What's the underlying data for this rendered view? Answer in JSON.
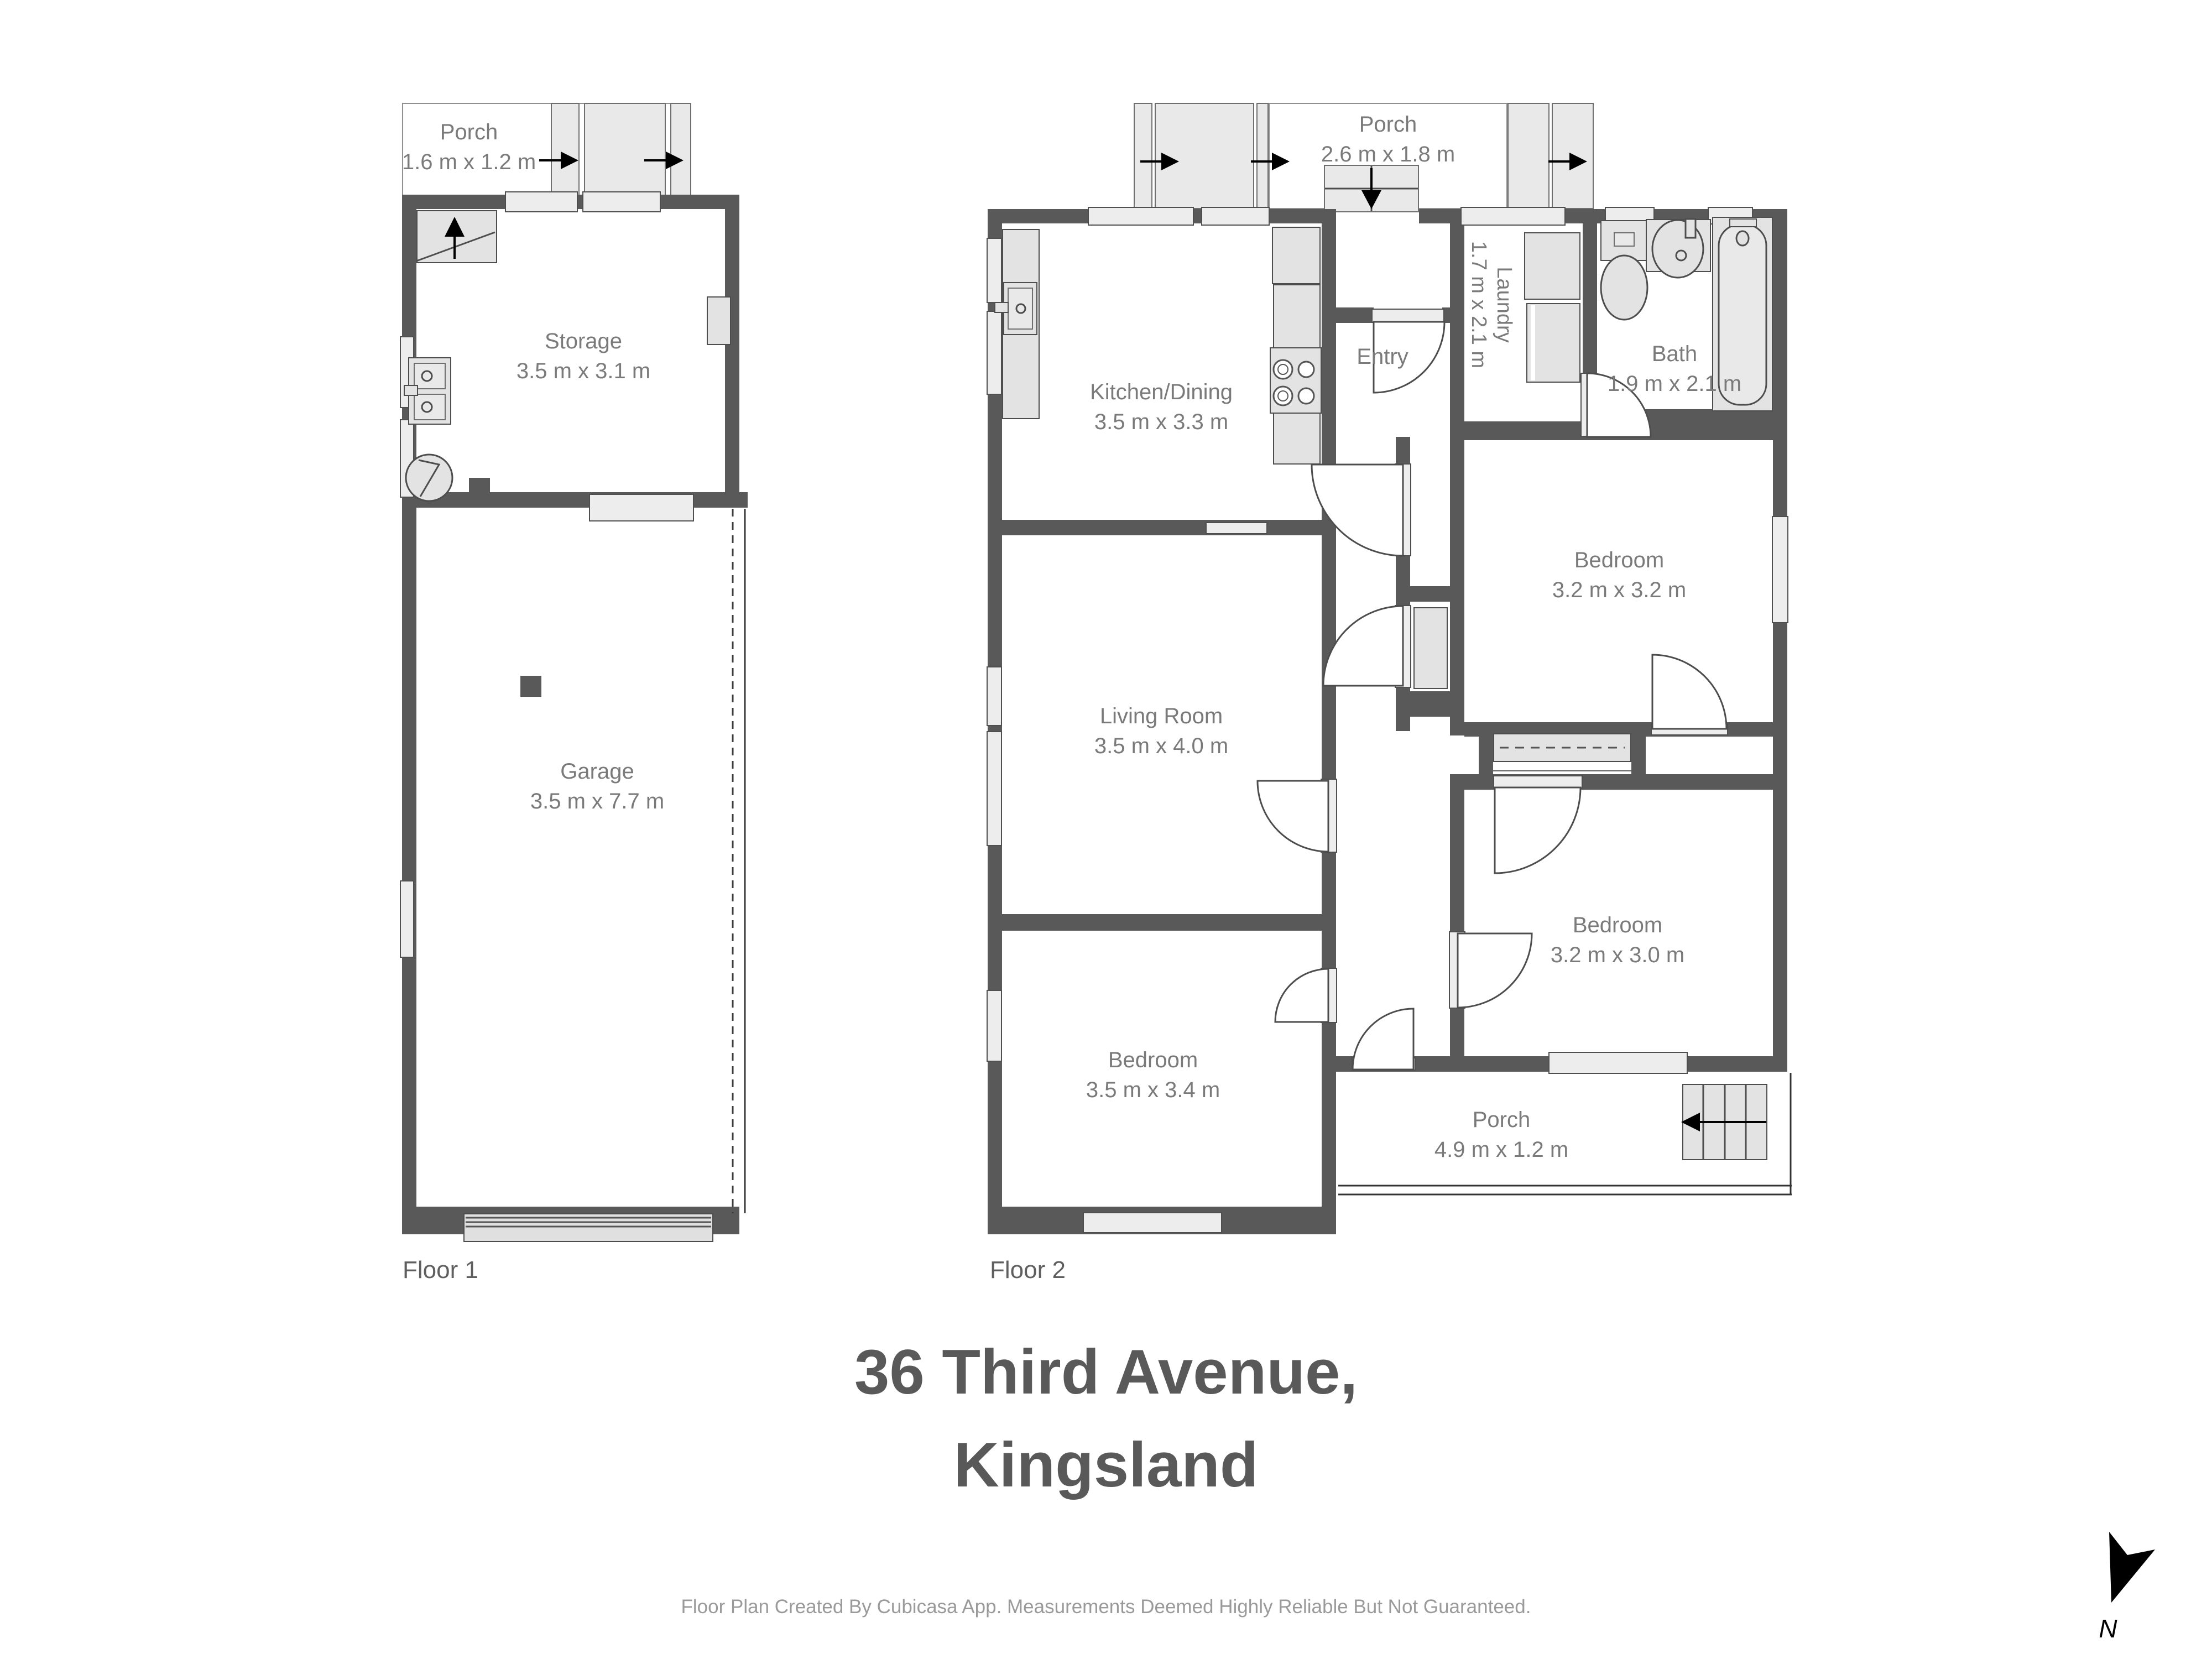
{
  "title": {
    "line1": "36 Third Avenue,",
    "line2": "Kingsland"
  },
  "footer": "Floor Plan Created By Cubicasa App. Measurements Deemed Highly Reliable But Not Guaranteed.",
  "compass": {
    "label": "N",
    "icon": "north-arrow-icon"
  },
  "floor1": {
    "label": "Floor 1",
    "rooms": {
      "porch": {
        "name": "Porch",
        "dims": "1.6 m x 1.2 m"
      },
      "storage": {
        "name": "Storage",
        "dims": "3.5 m x 3.1 m"
      },
      "garage": {
        "name": "Garage",
        "dims": "3.5 m x 7.7 m"
      }
    }
  },
  "floor2": {
    "label": "Floor 2",
    "rooms": {
      "porch_top": {
        "name": "Porch",
        "dims": "2.6 m x 1.8 m"
      },
      "kitchen": {
        "name": "Kitchen/Dining",
        "dims": "3.5 m x 3.3 m"
      },
      "entry": {
        "name": "Entry"
      },
      "laundry": {
        "name": "Laundry",
        "dims": "1.7 m x 2.1 m"
      },
      "bath": {
        "name": "Bath",
        "dims": "1.9 m x 2.1 m"
      },
      "bedroom1": {
        "name": "Bedroom",
        "dims": "3.2 m x 3.2 m"
      },
      "living": {
        "name": "Living Room",
        "dims": "3.5 m x 4.0 m"
      },
      "bedroom2": {
        "name": "Bedroom",
        "dims": "3.2 m x 3.0 m"
      },
      "bedroom3": {
        "name": "Bedroom",
        "dims": "3.5 m x 3.4 m"
      },
      "porch_bottom": {
        "name": "Porch",
        "dims": "4.9 m x 1.2 m"
      }
    }
  },
  "colors": {
    "wall": "#595959",
    "fixture": "#e3e3e3",
    "label": "#7a7a7a",
    "title": "#595959"
  }
}
